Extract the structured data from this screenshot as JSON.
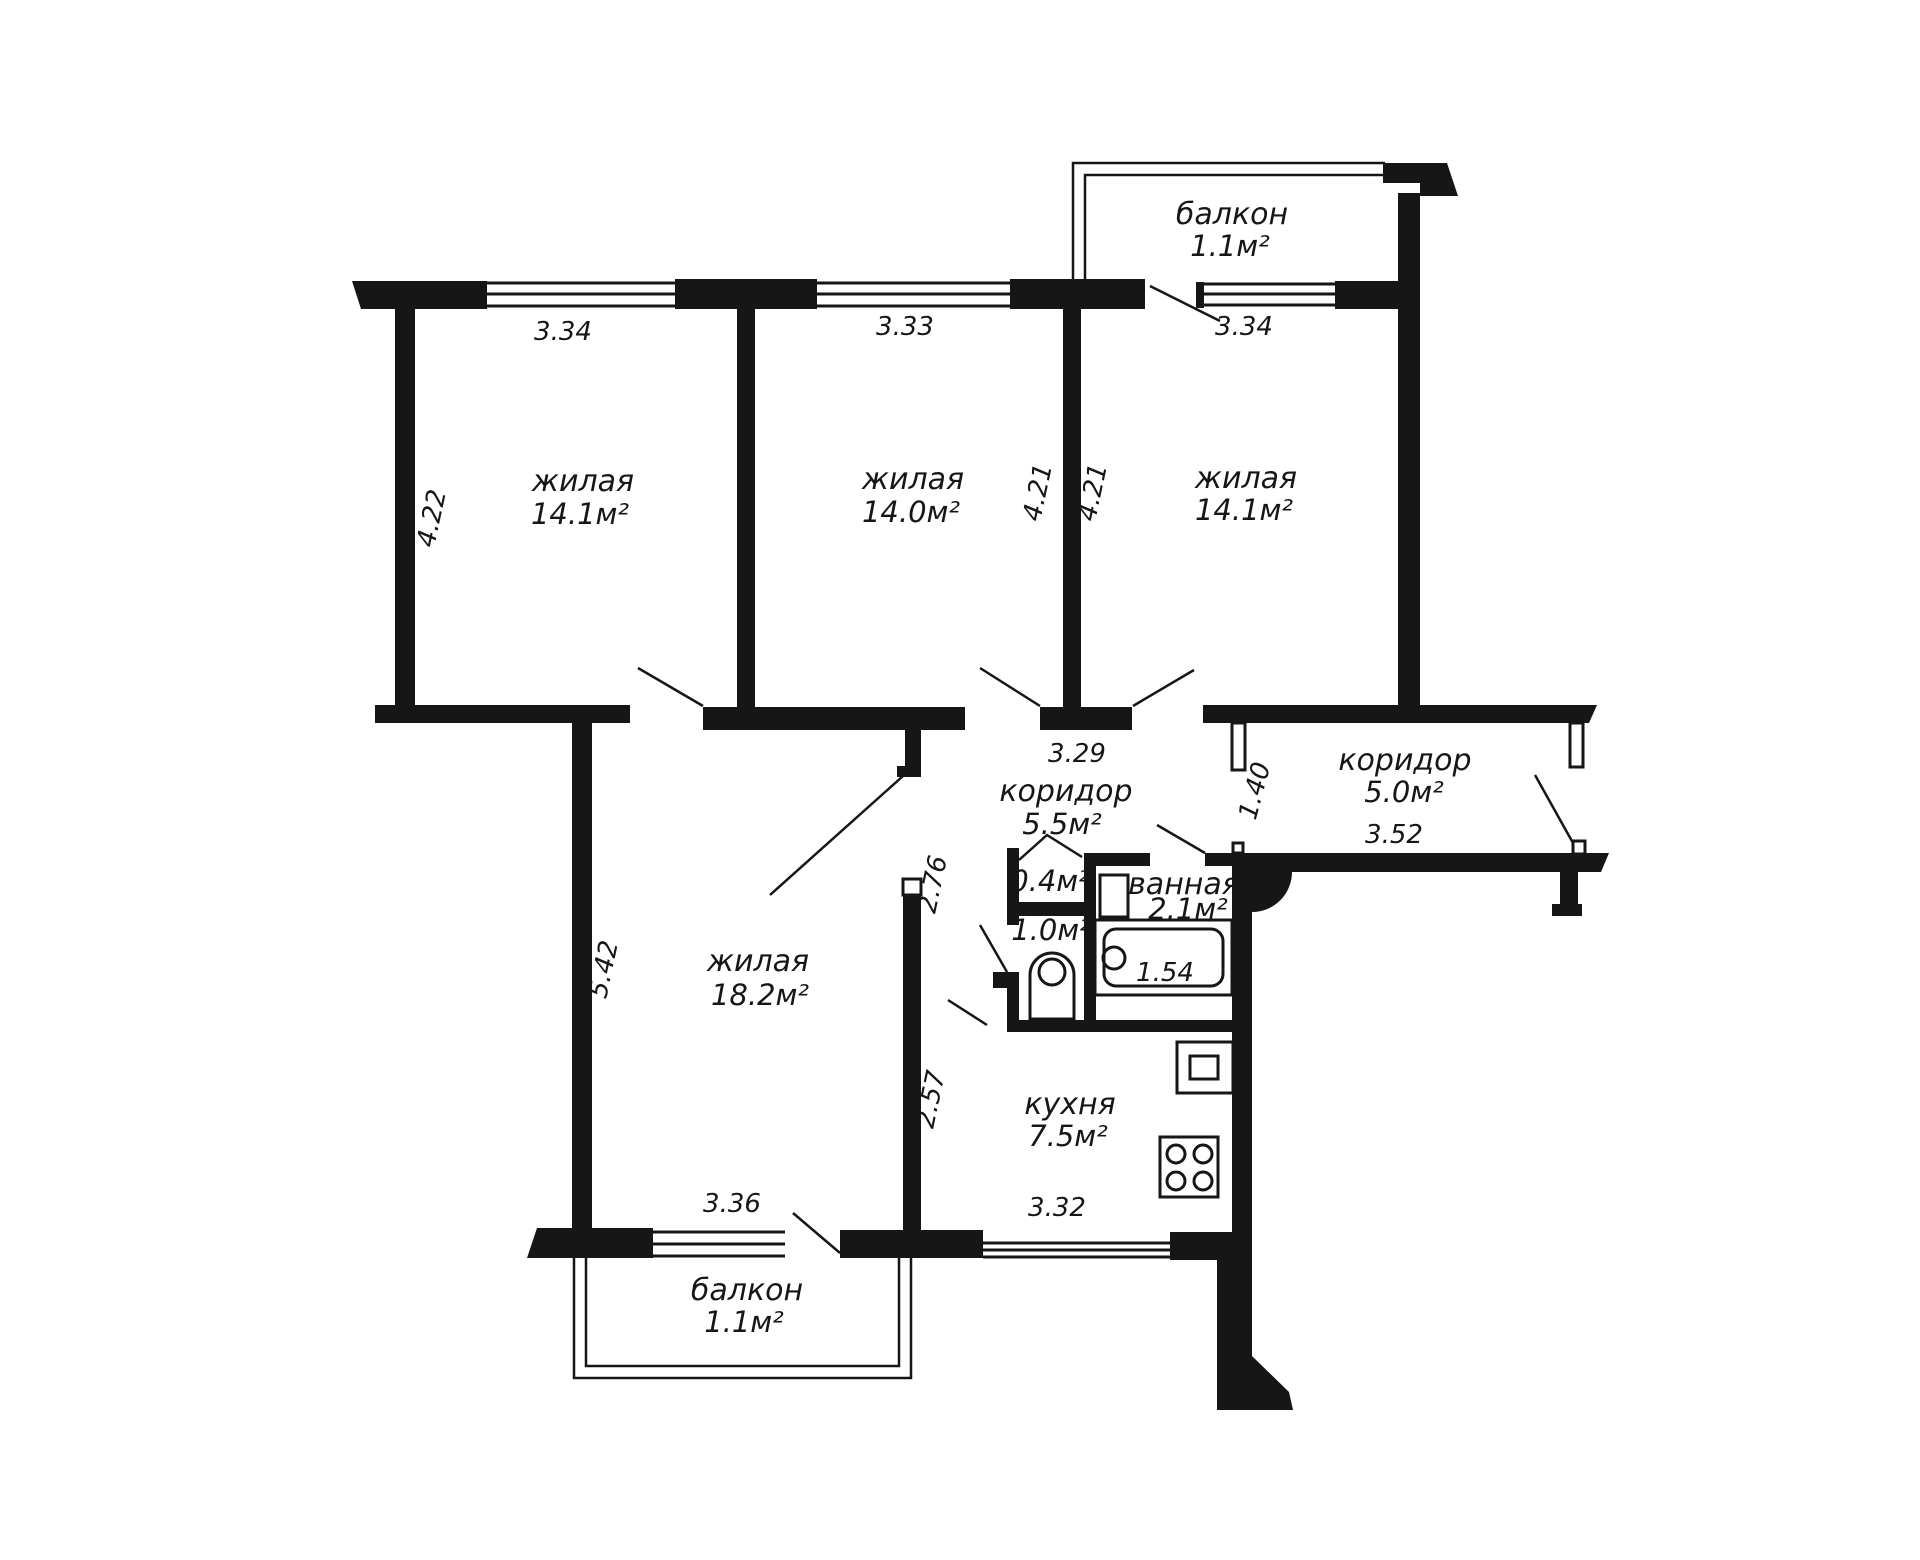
{
  "plan": {
    "type": "apartment floor plan",
    "language": "ru",
    "ink_color": "#161616",
    "paper_color": "#ffffff"
  },
  "rooms": {
    "living1": {
      "name": "жилая",
      "area": "14.1м²"
    },
    "living2": {
      "name": "жилая",
      "area": "14.0м²"
    },
    "living3": {
      "name": "жилая",
      "area": "14.1м²"
    },
    "living_large": {
      "name": "жилая",
      "area": "18.2м²"
    },
    "kitchen": {
      "name": "кухня",
      "area": "7.5м²"
    },
    "corridor_main": {
      "name": "коридор",
      "area": "5.5м²"
    },
    "corridor_entry": {
      "name": "коридор",
      "area": "5.0м²"
    },
    "bathroom": {
      "name": "ванная",
      "area": "2.1м²"
    },
    "wc": {
      "area": "1.0м²"
    },
    "storage": {
      "area": "0.4м²"
    },
    "balcony_top": {
      "name": "балкон",
      "area": "1.1м²"
    },
    "balcony_bottom": {
      "name": "балкон",
      "area": "1.1м²"
    }
  },
  "dimensions": {
    "living1_width": "3.34",
    "living2_width": "3.33",
    "living3_width": "3.34",
    "living1_depth": "4.22",
    "living2_depth": "4.21",
    "living3_depth": "4.21",
    "corridor_main_width": "3.29",
    "corridor_entry_height": "1.40",
    "corridor_entry_width": "3.52",
    "hall_upper_depth": "2.76",
    "kitchen_depth": "2.57",
    "living_large_depth": "5.42",
    "living_large_width": "3.36",
    "kitchen_width": "3.32",
    "bath_length": "1.54"
  }
}
